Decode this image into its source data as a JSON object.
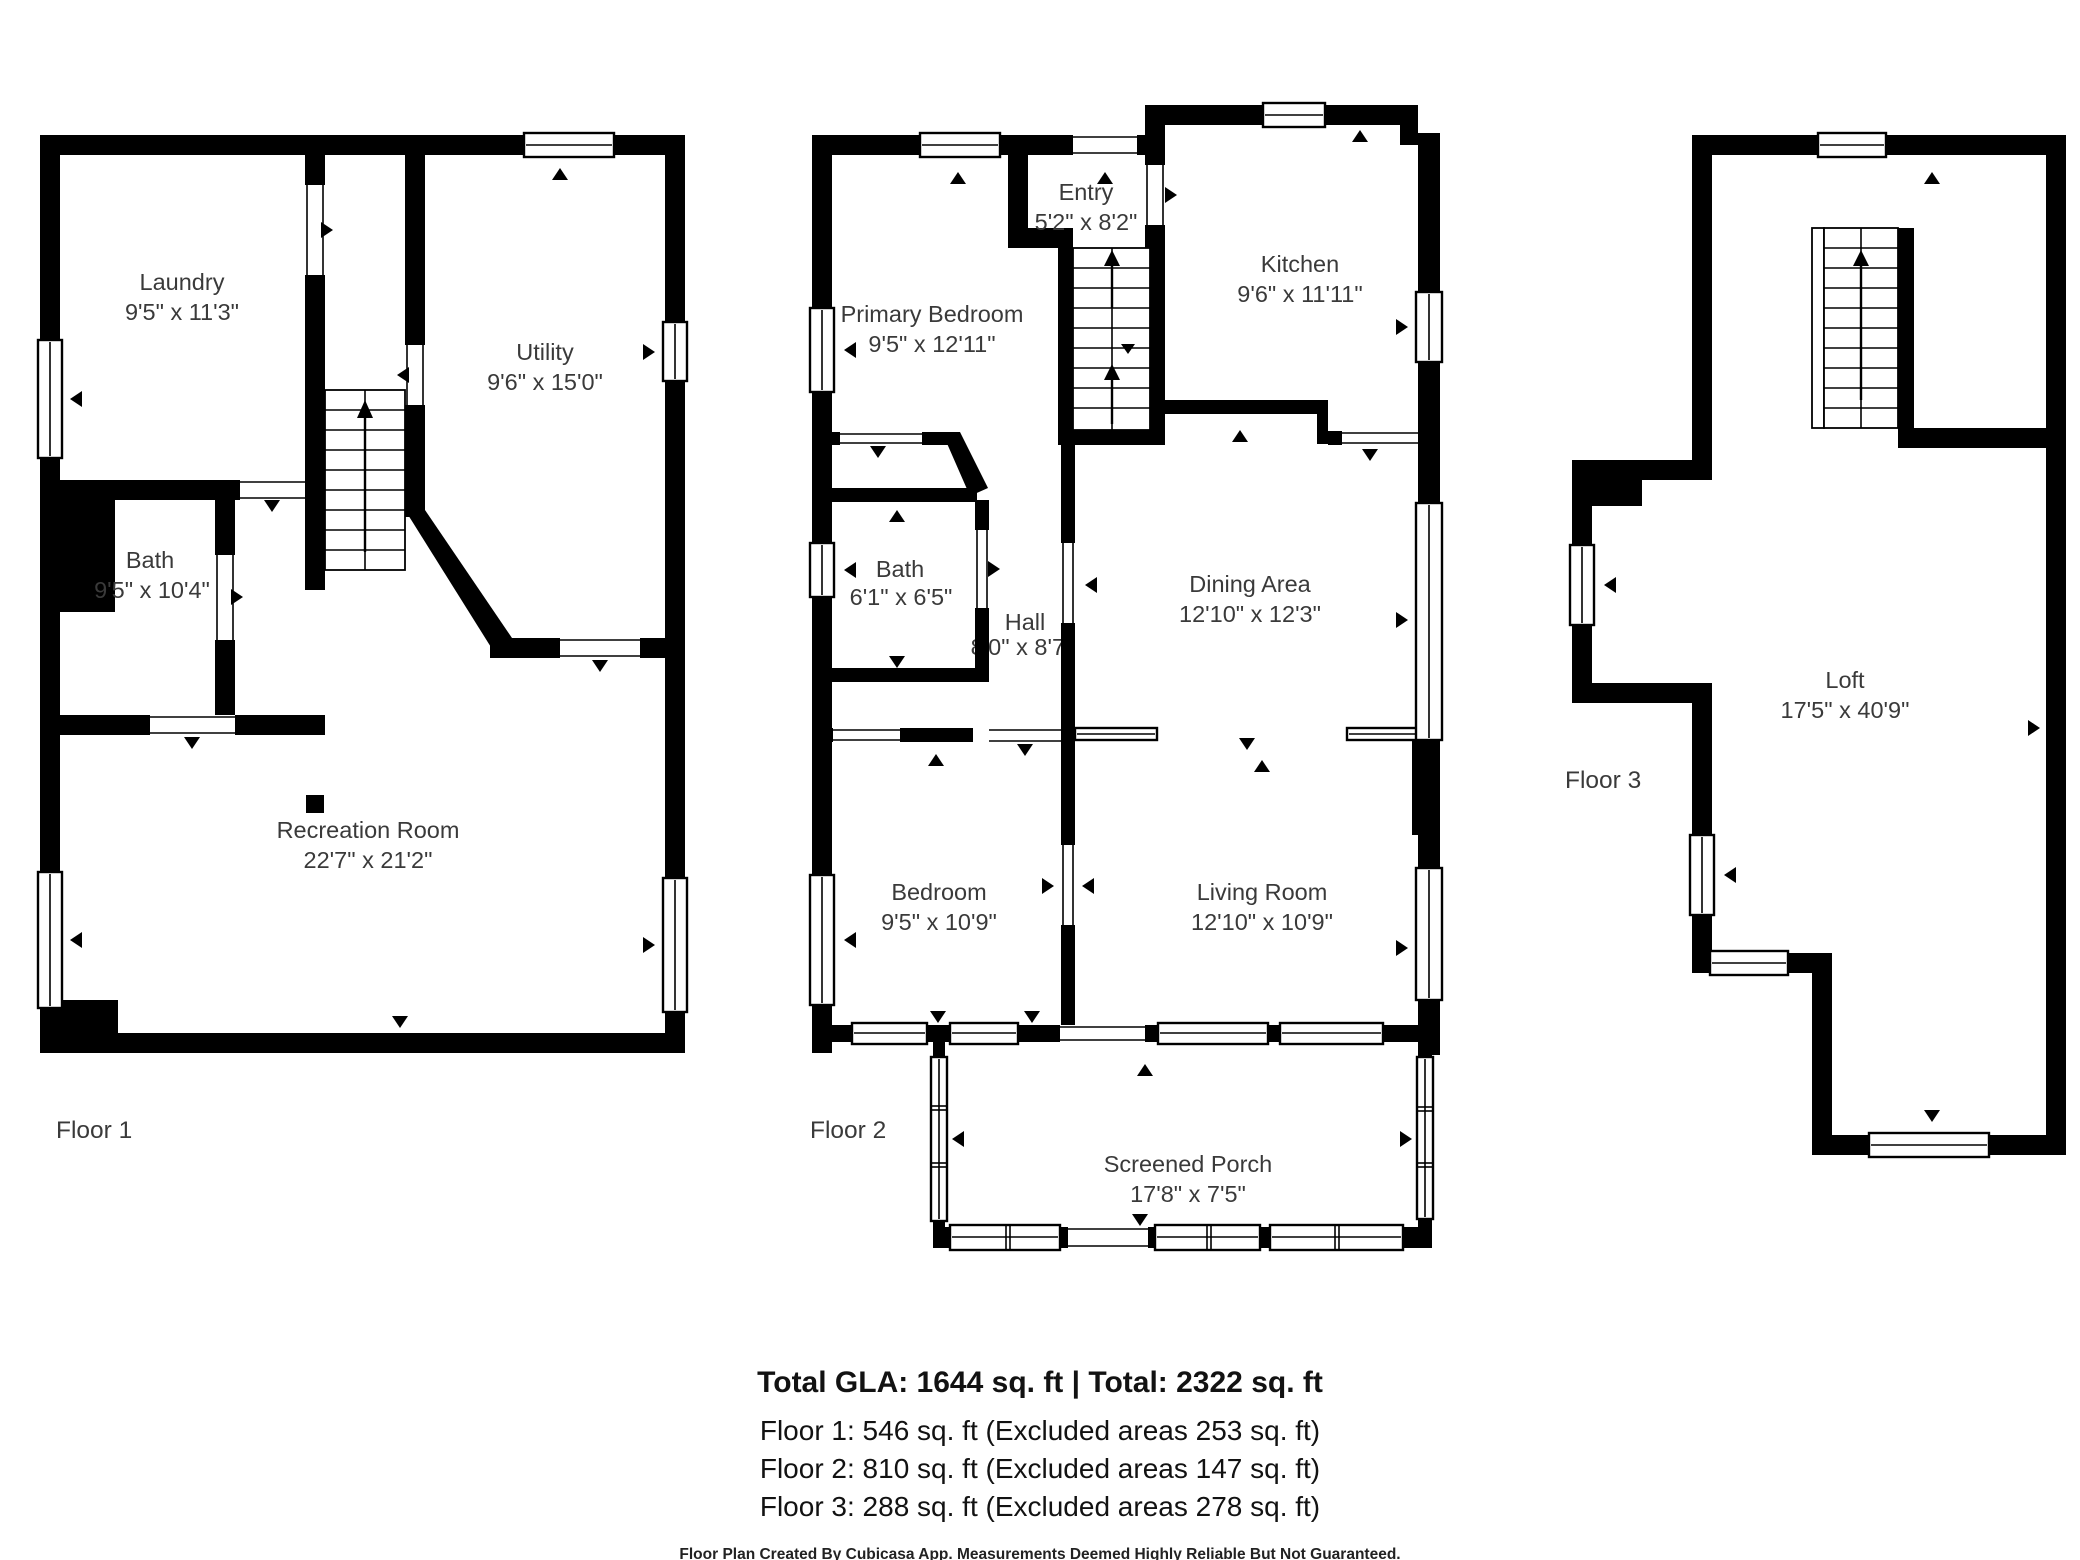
{
  "colors": {
    "wall": "#000000",
    "background": "#ffffff",
    "label_text": "#3a3a3a"
  },
  "floors": [
    {
      "label": "Floor 1",
      "rooms": [
        {
          "name": "Laundry",
          "dims": "9'5\" x 11'3\""
        },
        {
          "name": "Utility",
          "dims": "9'6\" x 15'0\""
        },
        {
          "name": "Bath",
          "dims": "9'5\" x 10'4\""
        },
        {
          "name": "Recreation Room",
          "dims": "22'7\" x 21'2\""
        }
      ]
    },
    {
      "label": "Floor 2",
      "rooms": [
        {
          "name": "Entry",
          "dims": "5'2\" x 8'2\""
        },
        {
          "name": "Primary Bedroom",
          "dims": "9'5\" x 12'11\""
        },
        {
          "name": "Kitchen",
          "dims": "9'6\" x 11'11\""
        },
        {
          "name": "Bath",
          "dims": "6'1\" x 6'5\""
        },
        {
          "name": "Hall",
          "dims": "8'0\" x 8'7\""
        },
        {
          "name": "Dining Area",
          "dims": "12'10\" x 12'3\""
        },
        {
          "name": "Bedroom",
          "dims": "9'5\" x 10'9\""
        },
        {
          "name": "Living Room",
          "dims": "12'10\" x 10'9\""
        },
        {
          "name": "Screened Porch",
          "dims": "17'8\" x 7'5\""
        }
      ]
    },
    {
      "label": "Floor 3",
      "rooms": [
        {
          "name": "Loft",
          "dims": "17'5\" x 40'9\""
        }
      ]
    }
  ],
  "summary": {
    "total": "Total GLA: 1644 sq. ft | Total: 2322 sq. ft",
    "floor1": "Floor 1: 546 sq. ft (Excluded areas 253 sq. ft)",
    "floor2": "Floor 2: 810 sq. ft (Excluded areas 147 sq. ft)",
    "floor3": "Floor 3: 288 sq. ft (Excluded areas 278 sq. ft)"
  },
  "disclaimer": "Floor Plan Created By Cubicasa App. Measurements Deemed Highly Reliable But Not Guaranteed."
}
